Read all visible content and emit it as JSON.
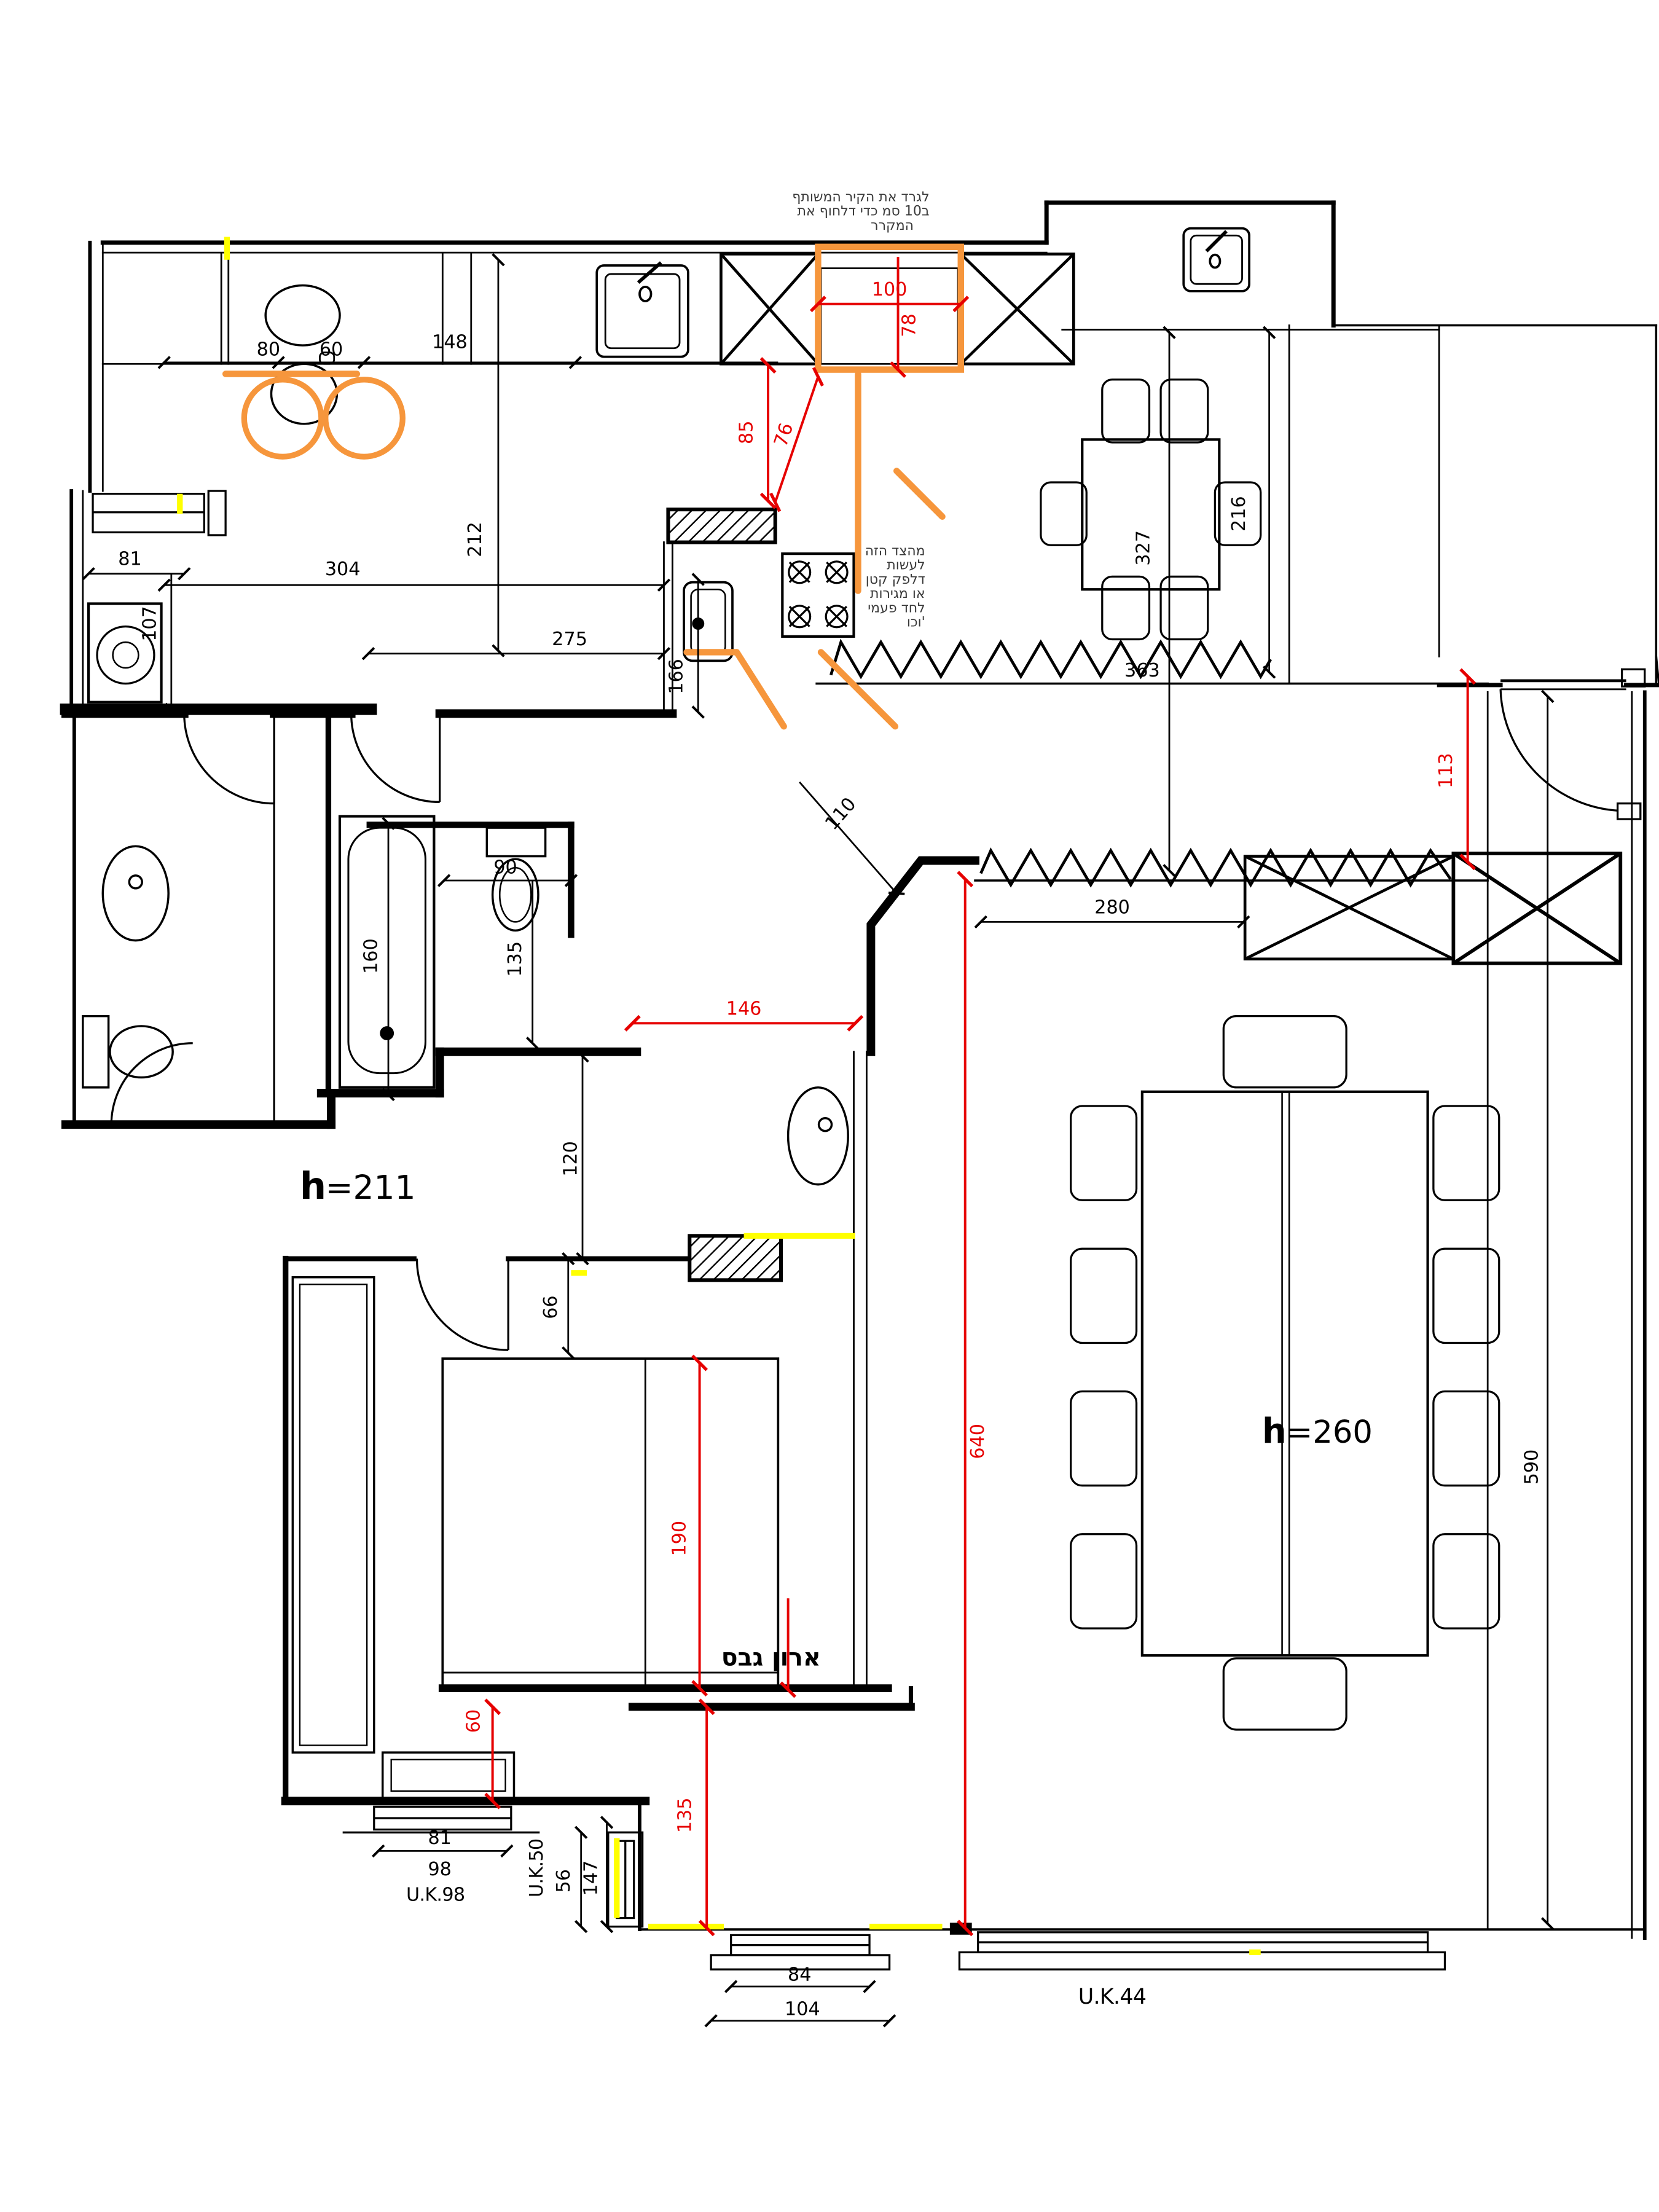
{
  "dims": {
    "counter_80": "80",
    "counter_60": "60",
    "counter_148": "148",
    "laundry_width_81": "81",
    "laundry_depth_107": "107",
    "kitchen_width_304": "304",
    "kitchen_width_275": "275",
    "kitchen_depth_212": "212",
    "island_166": "166",
    "dining_depth_327": "327",
    "dining_chair_216": "216",
    "break_363": "363",
    "living_width_280": "280",
    "diagonal_wall_110": "110",
    "toilet_offset_90": "90",
    "toilet_depth_135": "135",
    "bathtub_160": "160",
    "corridor_120": "120",
    "door_66": "66",
    "window_left_81": "81",
    "window_left_98": "98",
    "side_56": "56",
    "side_147": "147",
    "window_bottom_84": "84",
    "window_bottom_104": "104",
    "facade_590": "590"
  },
  "dims_red": {
    "fridge_width_100": "100",
    "fridge_depth_78": "78",
    "clearance_85": "85",
    "clearance_76": "76",
    "entry_113": "113",
    "opening_146": "146",
    "living_length_640": "640",
    "bed_190": "190",
    "bed_gap_60": "60",
    "bottom_135": "135"
  },
  "labels": {
    "gypsum_closet": "ארון גבס",
    "uk98": "U.K.98",
    "uk50": "U.K.50",
    "uk44": "U.K.44",
    "height_hall_h": "h",
    "height_hall_value": "=211",
    "height_living_h": "h",
    "height_living_value": "=260"
  },
  "notes": {
    "fridge_l1": "לגרד את הקיר המשותף",
    "fridge_l2": "ב10 סמ כדי דלחוף את",
    "fridge_l3": "המקרר",
    "counter_l1": "מהצד הזה",
    "counter_l2": "לעשות",
    "counter_l3": "דלפק קטן",
    "counter_l4": "או מגירות",
    "counter_l5": "לחד פעמי",
    "counter_l6": "וכו'"
  },
  "colors": {
    "red": "#e60000",
    "orange": "#f6963c",
    "yellow": "#ffff00",
    "black": "#000000"
  }
}
